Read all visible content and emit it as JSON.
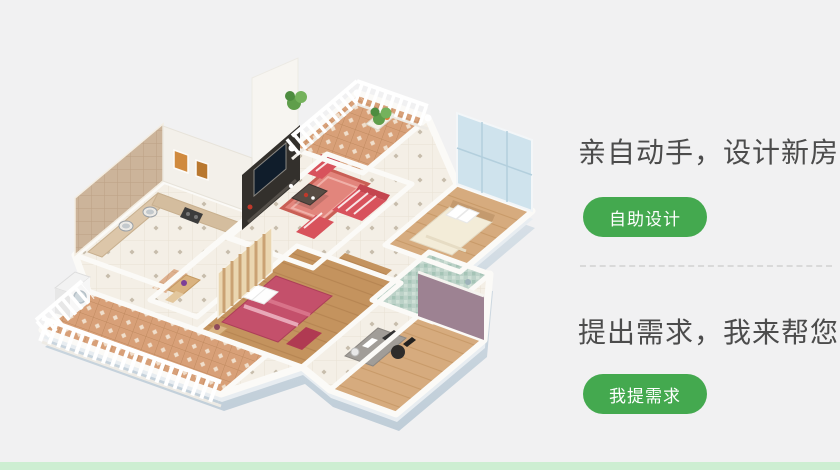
{
  "page": {
    "background_color": "#f1f1f2",
    "bottom_strip_color": "#cdeed2"
  },
  "cta": {
    "button_color": "#44a94f",
    "title_color": "#4c4c4c",
    "sections": [
      {
        "title": "亲自动手，设计新房",
        "button_label": "自助设计"
      },
      {
        "title": "提出需求，我来帮您",
        "button_label": "我提需求"
      }
    ]
  },
  "illustration": {
    "name": "3d-apartment-floorplan"
  }
}
